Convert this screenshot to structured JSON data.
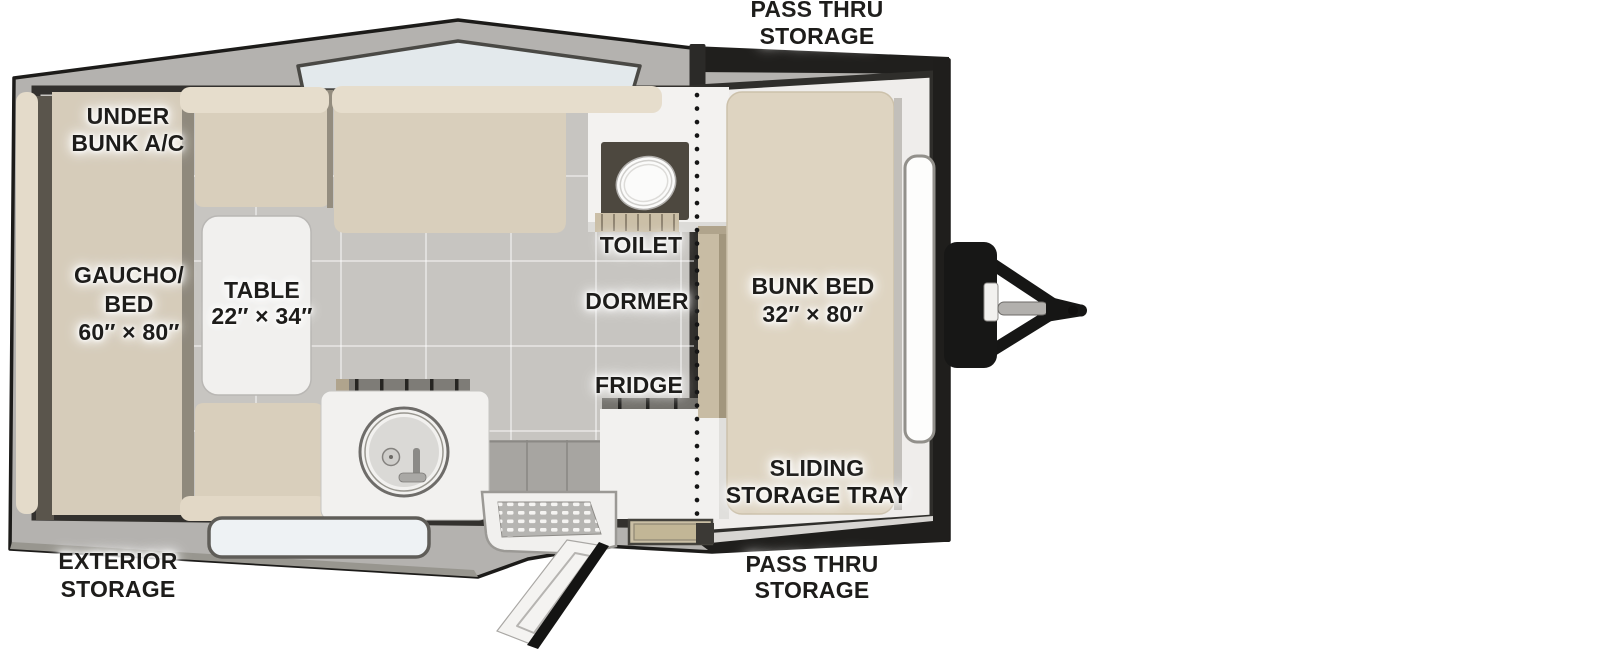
{
  "diagram": {
    "type": "travel-trailer-floorplan",
    "labels": {
      "pass_thru_top": {
        "l1": "PASS THRU",
        "l2": "STORAGE"
      },
      "under_bunk_ac": {
        "l1": "UNDER",
        "l2": "BUNK A/C"
      },
      "gaucho_bed": {
        "l1": "GAUCHO/",
        "l2": "BED",
        "l3": "60″ × 80″"
      },
      "table": {
        "l1": "TABLE",
        "l2": "22″ × 34″"
      },
      "toilet": {
        "l1": "TOILET"
      },
      "dormer": {
        "l1": "DORMER"
      },
      "fridge": {
        "l1": "FRIDGE"
      },
      "bunk_bed": {
        "l1": "BUNK BED",
        "l2": "32″ × 80″"
      },
      "sliding_storage_tray": {
        "l1": "SLIDING",
        "l2": "STORAGE TRAY"
      },
      "exterior_storage": {
        "l1": "EXTERIOR",
        "l2": "STORAGE"
      },
      "pass_thru_bottom": {
        "l1": "PASS THRU",
        "l2": "STORAGE"
      }
    },
    "colors": {
      "outline_black": "#1c1b19",
      "rim_gray": "#b4b2af",
      "floor_tile": "#c7c5c1",
      "front_floor": "#efedeb",
      "cushion_beige": "#d9cfbc",
      "bolster_beige": "#e5dccb",
      "bed_beige": "#d6ccba",
      "fixture_white": "#f2f1ef",
      "window_glass": "#e3e9ec",
      "wood_step_tan": "#cabfa5",
      "hitch_black": "#171716"
    }
  }
}
